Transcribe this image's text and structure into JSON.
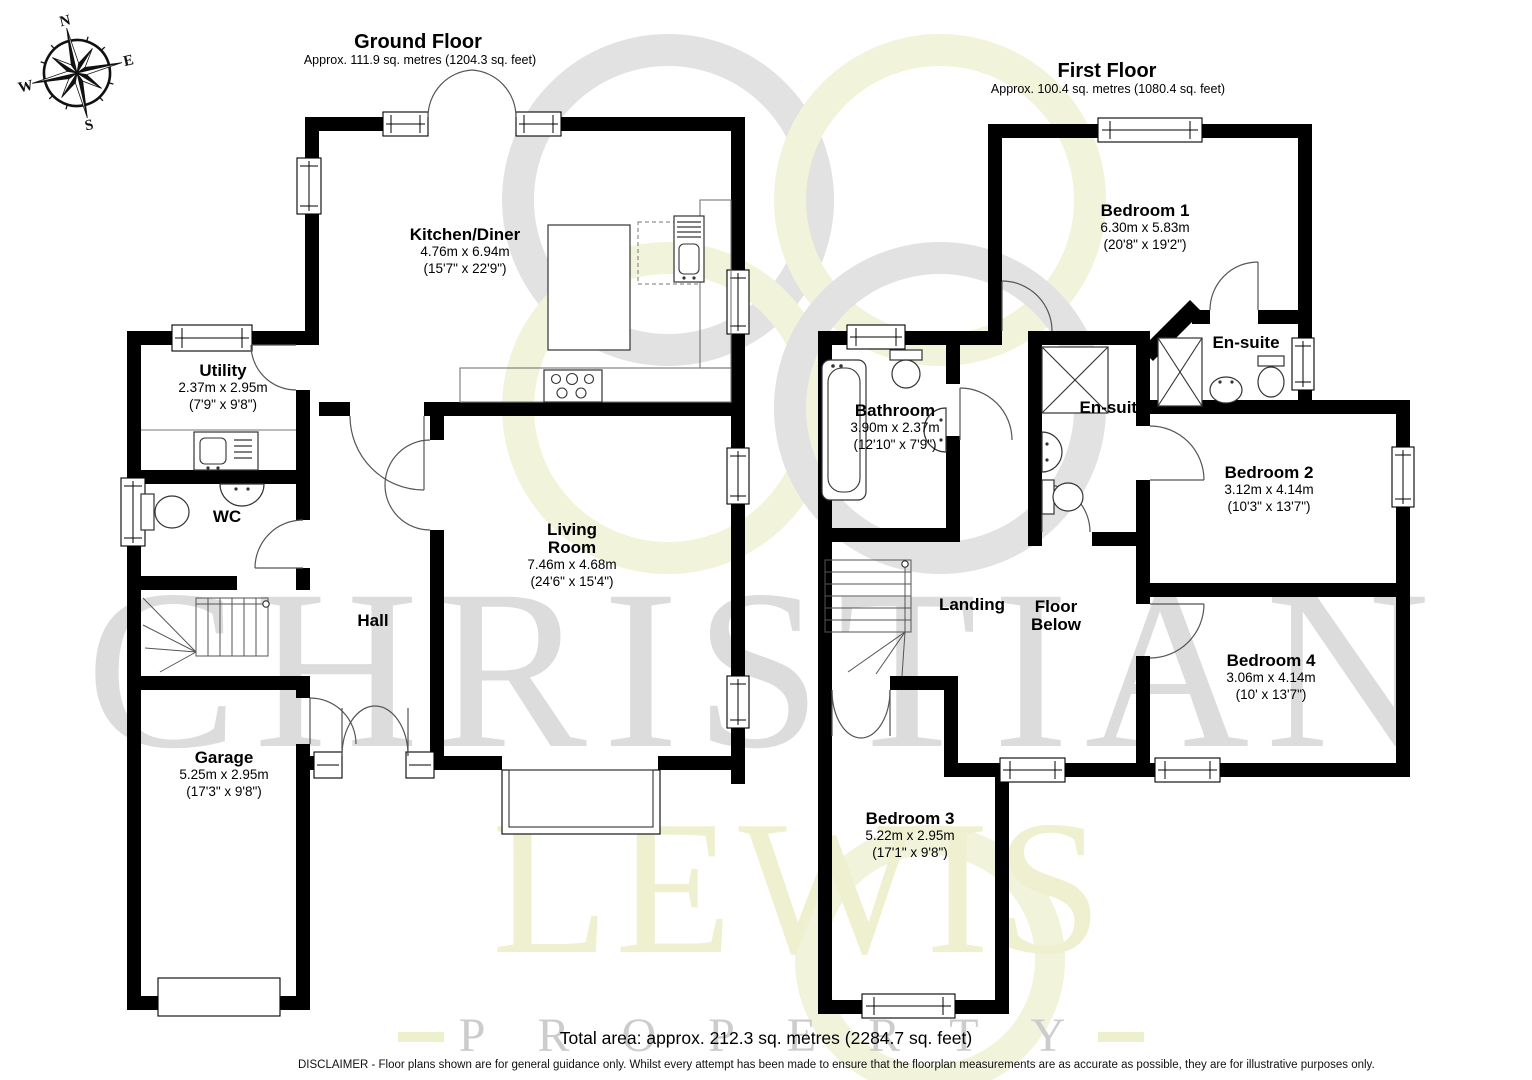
{
  "compass": {
    "north": "N",
    "east": "E",
    "south": "S",
    "west": "W"
  },
  "watermark": {
    "word1": "CHRISTIAN",
    "word2": "LEWIS",
    "word3": "PROPERTY",
    "gray": "#dcdcdc",
    "yellow": "#eef0d0",
    "logo_gray": "#e2e2e2",
    "logo_yellow": "#f1f3da"
  },
  "floors": [
    {
      "title": "Ground Floor",
      "area": "Approx. 111.9 sq. metres (1204.3 sq. feet)",
      "rooms": [
        {
          "name": "Kitchen/Diner",
          "size_m": "4.76m x 6.94m",
          "size_ft": "(15'7\" x 22'9\")"
        },
        {
          "name": "Utility",
          "size_m": "2.37m x 2.95m",
          "size_ft": "(7'9\" x 9'8\")"
        },
        {
          "name": "WC"
        },
        {
          "name": "Hall"
        },
        {
          "name": "Living\nRoom",
          "size_m": "7.46m x 4.68m",
          "size_ft": "(24'6\" x 15'4\")"
        },
        {
          "name": "Garage",
          "size_m": "5.25m x 2.95m",
          "size_ft": "(17'3\" x 9'8\")"
        }
      ]
    },
    {
      "title": "First Floor",
      "area": "Approx. 100.4 sq. metres (1080.4 sq. feet)",
      "rooms": [
        {
          "name": "Bedroom 1",
          "size_m": "6.30m x 5.83m",
          "size_ft": "(20'8\" x 19'2\")"
        },
        {
          "name": "En-suite"
        },
        {
          "name": "En-suite"
        },
        {
          "name": "Bathroom",
          "size_m": "3.90m x 2.37m",
          "size_ft": "(12'10\" x 7'9\")"
        },
        {
          "name": "Bedroom 2",
          "size_m": "3.12m x 4.14m",
          "size_ft": "(10'3\" x 13'7\")"
        },
        {
          "name": "Landing"
        },
        {
          "name": "Floor\nBelow"
        },
        {
          "name": "Bedroom 4",
          "size_m": "3.06m x 4.14m",
          "size_ft": "(10' x 13'7\")"
        },
        {
          "name": "Bedroom 3",
          "size_m": "5.22m x 2.95m",
          "size_ft": "(17'1\" x 9'8\")"
        }
      ]
    }
  ],
  "footer": {
    "total_area": "Total area: approx. 212.3 sq. metres (2284.7 sq. feet)",
    "disclaimer": "DISCLAIMER -  Floor plans shown are for general guidance only. Whilst every attempt has been made to ensure that the floorplan measurements are as accurate as possible, they are for illustrative purposes only."
  }
}
